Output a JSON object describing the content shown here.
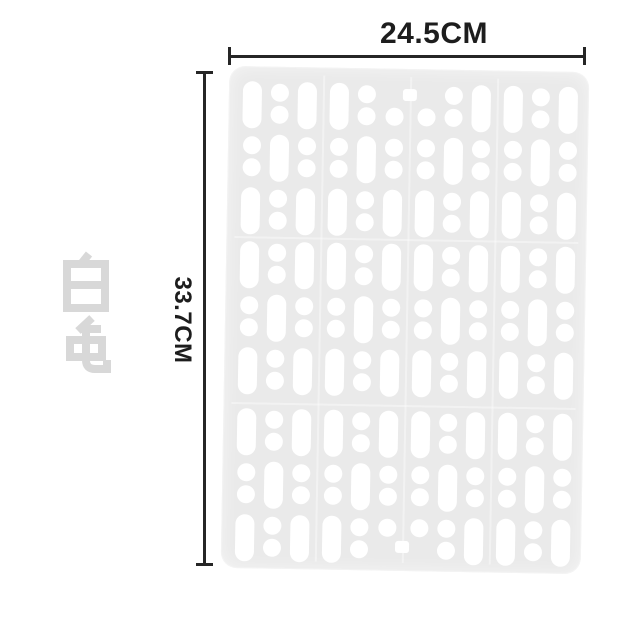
{
  "page": {
    "background": "#ffffff",
    "type": "product-dimension-diagram"
  },
  "color_variant": {
    "text": "白色",
    "color": "#d8d8d8"
  },
  "dimensions": {
    "width_label": "24.5CM",
    "height_label": "33.7CM",
    "line_color": "#262626"
  },
  "mat": {
    "description": "white perforated plastic drain mat with pill slots and paired round holes",
    "fill": "#eaeaea",
    "hole_color": "#ffffff",
    "bands": 3,
    "rows_per_band": 3,
    "blocks": 4,
    "cols_per_block": 3,
    "unit_types": [
      "pill",
      "circle-pair"
    ],
    "pattern": "within each 3x3 block a checkerboard starting with a pill slot",
    "exceptions": [
      {
        "row": 0,
        "col": 5,
        "type": "circle-bottom"
      },
      {
        "row": 0,
        "col": 6,
        "type": "circle-bottom"
      },
      {
        "row": 8,
        "col": 5,
        "type": "circle-top"
      },
      {
        "row": 8,
        "col": 6,
        "type": "circle-top"
      }
    ],
    "notches": [
      "top-center",
      "bottom-center"
    ]
  }
}
